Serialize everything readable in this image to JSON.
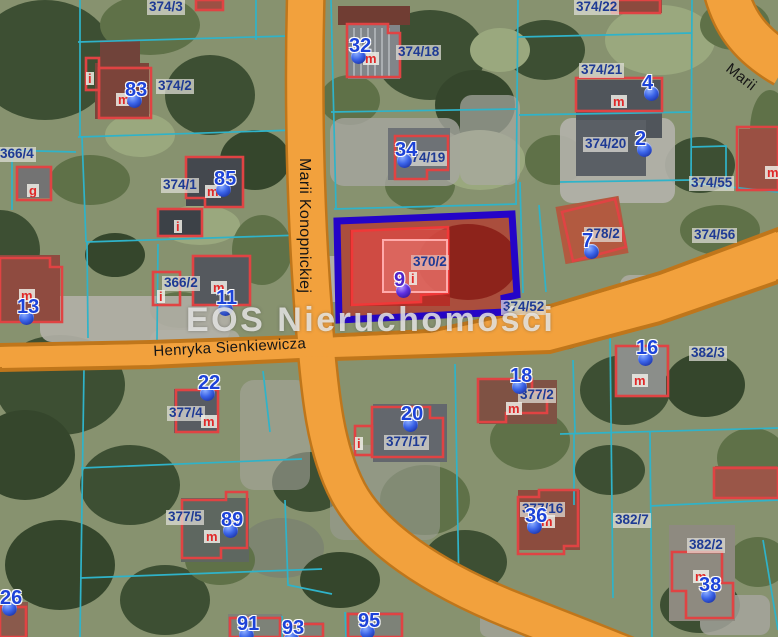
{
  "map": {
    "watermark": "EOS Nieruchomości",
    "streets": [
      {
        "name": "Marii Konopnickiej",
        "x": 313,
        "y": 158,
        "rotation": 90,
        "vertical": true
      },
      {
        "name": "Henryka Sienkiewicza",
        "x": 153,
        "y": 343,
        "rotation": -3,
        "vertical": false
      },
      {
        "name": "Marii",
        "x": 733,
        "y": 60,
        "rotation": 38,
        "vertical": false
      }
    ],
    "highlighted_parcel": {
      "id": "370/2",
      "marker": "9"
    },
    "parcel_labels": [
      {
        "text": "374/3",
        "x": 147,
        "y": 0
      },
      {
        "text": "374/2",
        "x": 156,
        "y": 79
      },
      {
        "text": "366/4",
        "x": -2,
        "y": 147
      },
      {
        "text": "374/1",
        "x": 161,
        "y": 178
      },
      {
        "text": "374/18",
        "x": 396,
        "y": 45
      },
      {
        "text": "374/19",
        "x": 402,
        "y": 151
      },
      {
        "text": "374/22",
        "x": 574,
        "y": 0
      },
      {
        "text": "374/21",
        "x": 579,
        "y": 63
      },
      {
        "text": "374/20",
        "x": 583,
        "y": 137
      },
      {
        "text": "374/55",
        "x": 689,
        "y": 176
      },
      {
        "text": "374/56",
        "x": 692,
        "y": 228
      },
      {
        "text": "378/2",
        "x": 584,
        "y": 227
      },
      {
        "text": "366/2",
        "x": 162,
        "y": 276
      },
      {
        "text": "370/2",
        "x": 411,
        "y": 255,
        "variant": "on-red"
      },
      {
        "text": "374/52",
        "x": 501,
        "y": 300
      },
      {
        "text": "382/3",
        "x": 689,
        "y": 346
      },
      {
        "text": "377/4",
        "x": 167,
        "y": 406
      },
      {
        "text": "377/17",
        "x": 384,
        "y": 435
      },
      {
        "text": "377/2",
        "x": 518,
        "y": 388
      },
      {
        "text": "377/5",
        "x": 166,
        "y": 510
      },
      {
        "text": "377/16",
        "x": 520,
        "y": 502
      },
      {
        "text": "382/7",
        "x": 613,
        "y": 513
      },
      {
        "text": "382/2",
        "x": 687,
        "y": 538
      }
    ],
    "markers": [
      {
        "label": "83",
        "x": 125,
        "y": 80
      },
      {
        "label": "32",
        "x": 349,
        "y": 36
      },
      {
        "label": "34",
        "x": 395,
        "y": 140
      },
      {
        "label": "4",
        "x": 642,
        "y": 73
      },
      {
        "label": "2",
        "x": 635,
        "y": 129
      },
      {
        "label": "85",
        "x": 214,
        "y": 169
      },
      {
        "label": "7",
        "x": 582,
        "y": 231
      },
      {
        "label": "13",
        "x": 17,
        "y": 297
      },
      {
        "label": "11",
        "x": 216,
        "y": 288
      },
      {
        "label": "9",
        "x": 394,
        "y": 270,
        "variant": "purple"
      },
      {
        "label": "22",
        "x": 198,
        "y": 373
      },
      {
        "label": "20",
        "x": 401,
        "y": 404
      },
      {
        "label": "18",
        "x": 510,
        "y": 366
      },
      {
        "label": "16",
        "x": 636,
        "y": 338
      },
      {
        "label": "89",
        "x": 221,
        "y": 510
      },
      {
        "label": "36",
        "x": 525,
        "y": 506
      },
      {
        "label": "38",
        "x": 699,
        "y": 575
      },
      {
        "label": "26",
        "x": 0,
        "y": 588
      },
      {
        "label": "91",
        "x": 237,
        "y": 614
      },
      {
        "label": "93",
        "x": 282,
        "y": 618
      },
      {
        "label": "95",
        "x": 358,
        "y": 611
      }
    ],
    "building_tags": [
      {
        "text": "m",
        "x": 116,
        "y": 93
      },
      {
        "text": "i",
        "x": 86,
        "y": 72
      },
      {
        "text": "g",
        "x": 27,
        "y": 184
      },
      {
        "text": "m",
        "x": 205,
        "y": 185
      },
      {
        "text": "m",
        "x": 363,
        "y": 52
      },
      {
        "text": "m",
        "x": 611,
        "y": 95
      },
      {
        "text": "m",
        "x": 765,
        "y": 166
      },
      {
        "text": "i",
        "x": 174,
        "y": 220
      },
      {
        "text": "i",
        "x": 157,
        "y": 290
      },
      {
        "text": "m",
        "x": 211,
        "y": 281
      },
      {
        "text": "m",
        "x": 19,
        "y": 289
      },
      {
        "text": "m",
        "x": 201,
        "y": 415
      },
      {
        "text": "i",
        "x": 355,
        "y": 437
      },
      {
        "text": "m",
        "x": 506,
        "y": 402
      },
      {
        "text": "m",
        "x": 632,
        "y": 374
      },
      {
        "text": "m",
        "x": 204,
        "y": 530
      },
      {
        "text": "m",
        "x": 539,
        "y": 515
      },
      {
        "text": "m",
        "x": 693,
        "y": 570
      },
      {
        "text": "i",
        "x": 409,
        "y": 272
      }
    ],
    "colors": {
      "road_fill": "#f2a13d",
      "road_border": "#bf761b",
      "parcel_line": "#2fb3c9",
      "building_outline": "#e04343",
      "highlight_border": "#2404c8",
      "highlight_fill": "rgba(203,16,16,0.52)",
      "marker_blue": "#1d43d8",
      "marker_purple": "#4f25c9",
      "label_text": "#1e3a94",
      "tag_text": "#e02828",
      "watermark_text": "rgba(236,236,234,0.82)"
    }
  }
}
